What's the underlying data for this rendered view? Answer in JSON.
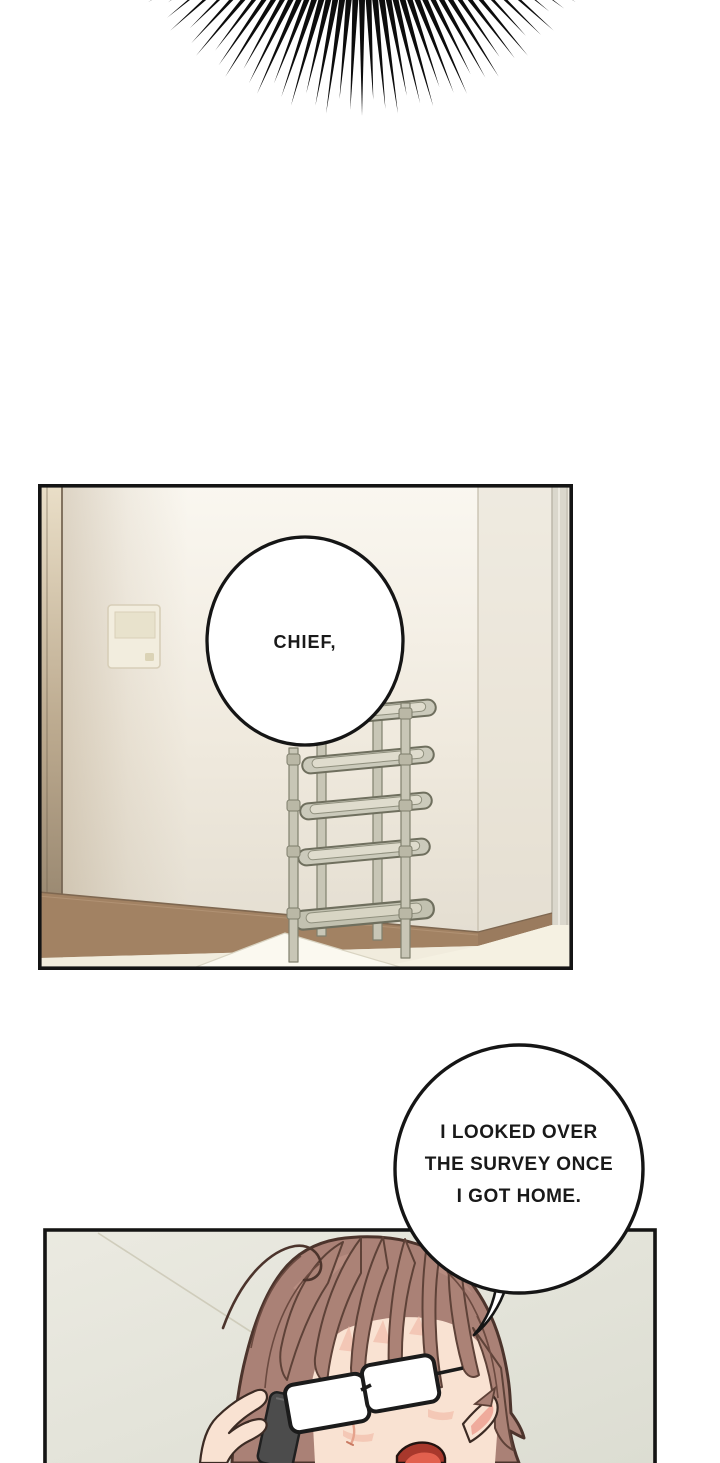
{
  "page": {
    "kind": "webtoon comic page",
    "width": 720,
    "height": 1463,
    "background": "#ffffff"
  },
  "effects": {
    "burst": {
      "center_x": 362,
      "center_y": -142,
      "inner_radius": 118,
      "outer_radius": 258,
      "spike_count": 43,
      "half_angle_deg": 56,
      "base_width": 7.2,
      "length_pattern": [
        0,
        16,
        6
      ],
      "color": "#0c0c0c"
    }
  },
  "panel_room": {
    "description": "empty apartment entryway corner with wall intercom panel and plastic shoe rack",
    "border_color": "#141414",
    "wall_top": "#faf7f0",
    "wall_bottom": "#e3ddd0",
    "baseboard": "#a28263",
    "floor": "#f1ecdd",
    "rack_frame": "#c8c6b6",
    "rack_outline": "#6f6f5e"
  },
  "panel_phone": {
    "description": "woman with brown hair and glasses holding a phone to her ear, mouth open",
    "border_color": "#141414",
    "wall": "#e9e8df",
    "hair": "#aa8176",
    "skin": "#f9e2d2",
    "phone": "#4c4c4c"
  },
  "bubbles": {
    "chief": {
      "text": "CHIEF,"
    },
    "survey": {
      "lines": [
        "I LOOKED OVER",
        "THE SURVEY ONCE",
        "I GOT HOME."
      ]
    }
  }
}
